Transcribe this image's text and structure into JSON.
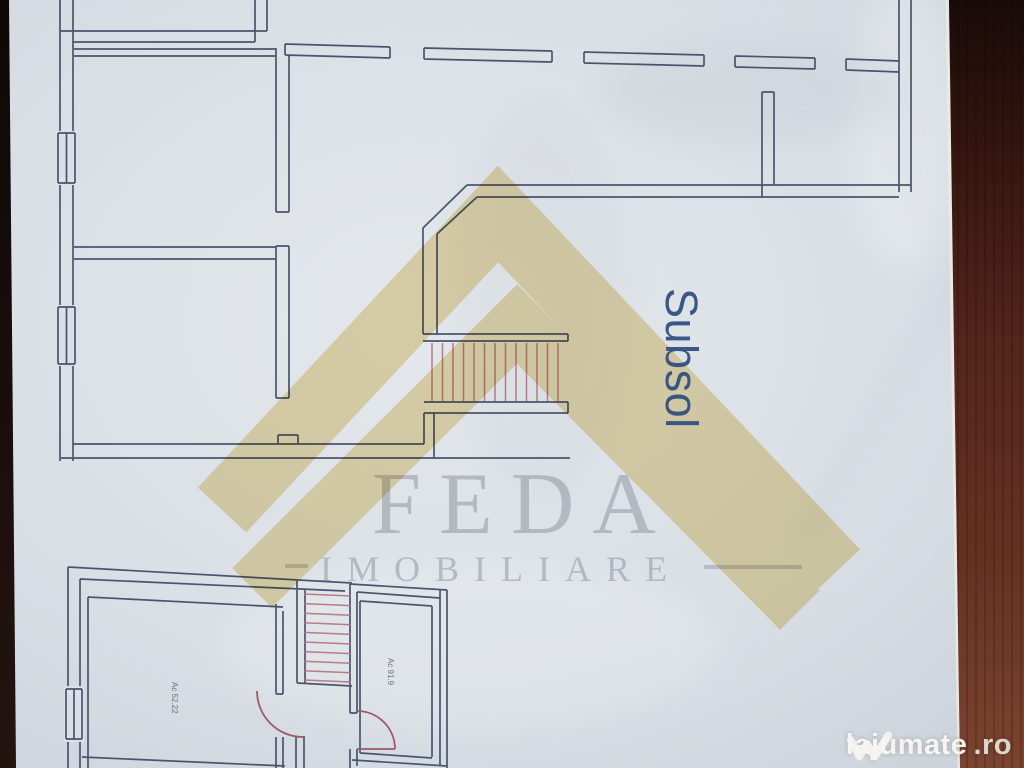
{
  "photo": {
    "floor_plans": {
      "basement": {
        "level_label": "Subsol"
      },
      "lower_level": {
        "left_room_label": "Ac 52.22",
        "right_room_label": "Ac 91.9"
      }
    },
    "agency_watermark": {
      "brand": "FEDA",
      "tagline": "IMOBILIARE"
    },
    "site_watermark": {
      "name": "lajumate",
      "tld": ".ro"
    },
    "colors": {
      "plan_line": "#49556e",
      "stair_hatch_red": "#b2707a",
      "door_arc_red": "#9d5a64",
      "watermark_yellow": "#e3c97c",
      "watermark_gray": "#9aa0aa",
      "level_label_blue": "#2e4c7e",
      "paper": "#d9dfe5",
      "background_wood_dark": "#1a0c08",
      "background_wood_light": "#7b4430"
    }
  }
}
